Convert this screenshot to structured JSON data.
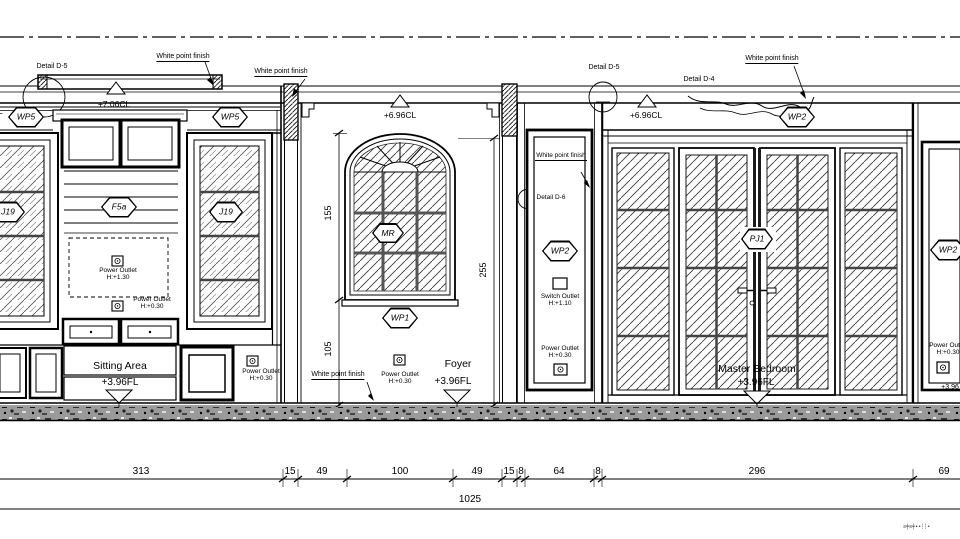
{
  "finish_note": "White point finish",
  "levels": {
    "cl_left": "+7.06CL",
    "cl_mid": "+6.96CL",
    "cl_right": "+6.96CL",
    "fl": "+3.96FL",
    "fl_partial": "+3.96"
  },
  "rooms": {
    "sitting": "Sitting Area",
    "foyer": "Foyer",
    "master": "Master Bedroom"
  },
  "tags": {
    "wp5": "WP5",
    "wp1": "WP1",
    "wp2": "WP2",
    "f5a": "F5a",
    "j19": "J19",
    "mr": "MR",
    "pj1": "PJ1",
    "edge_cut": "L"
  },
  "details": {
    "d5": "Detail D-5",
    "d4": "Detail D-4",
    "d6": "Detail D-6"
  },
  "electrical": {
    "power_outlet": "Power Outlet",
    "switch_outlet": "Switch Outlet",
    "h130": "H:+1.30",
    "h030": "H:+0.30",
    "h110": "H:+1.10"
  },
  "dims": {
    "segments": [
      "313",
      "15",
      "49",
      "100",
      "49",
      "15",
      "8",
      "64",
      "8",
      "296",
      "69"
    ],
    "total": "1025",
    "v155": "155",
    "v105": "105",
    "v255": "255"
  },
  "stamp": "≡╪≡╪∙∙┆┆∙"
}
